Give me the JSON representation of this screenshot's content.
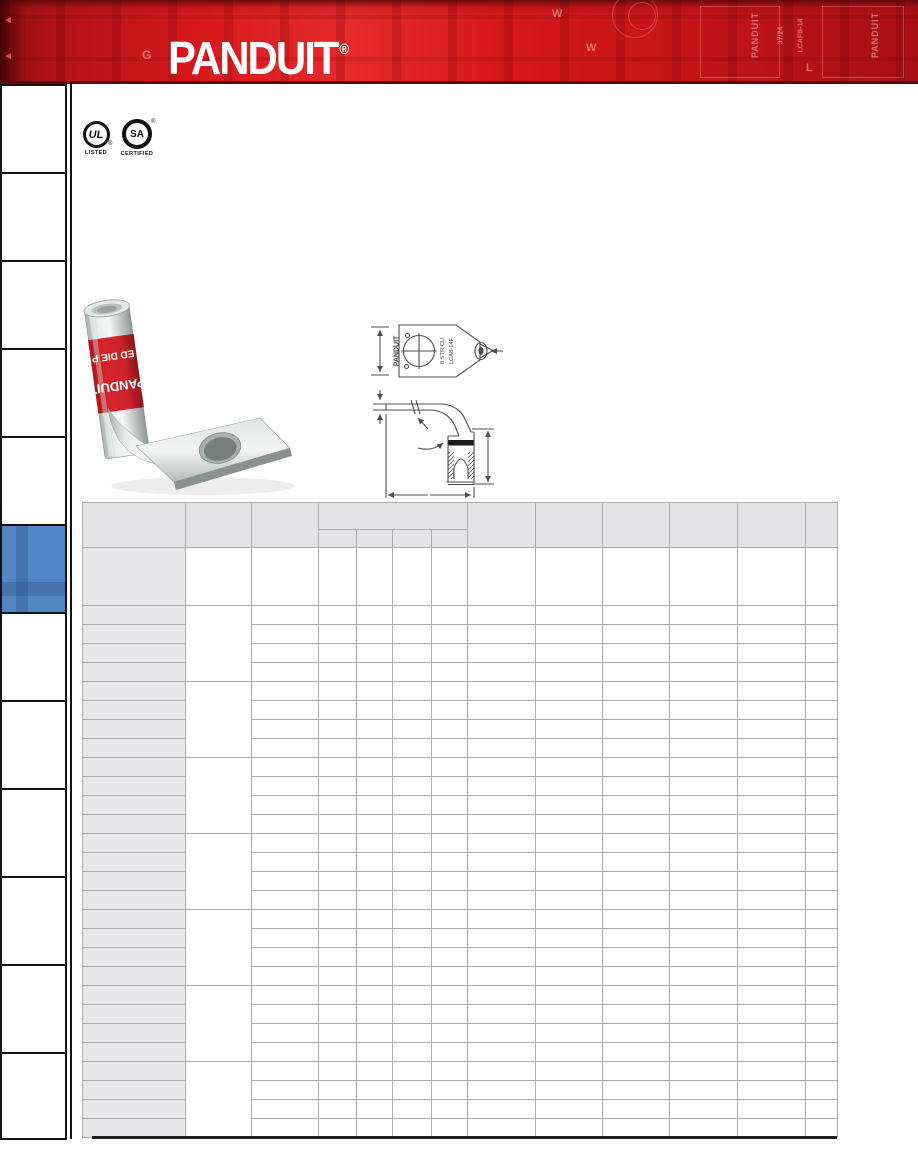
{
  "brand": {
    "logo_text": "PANDUIT",
    "registered": "®"
  },
  "header_pattern": {
    "labels": {
      "g": "G",
      "w_vert": "W",
      "w_dim": "W",
      "l": "L",
      "panduit1": "PANDUIT",
      "panduit2": "PANDUIT",
      "part1": "37/24",
      "part2": "LCAFB-14"
    }
  },
  "certifications": {
    "ul": {
      "monogram": "UL",
      "caption": "LISTED",
      "registered": "®"
    },
    "csa": {
      "monogram": "SA",
      "caption": "CERTIFIED",
      "registered": "®"
    }
  },
  "sidebar": {
    "tab_count": 12,
    "active_index": 5,
    "active_color": "#5285c6"
  },
  "product_photo": {
    "band_line1": "ED DIE P",
    "band_line2": "PANDUIT"
  },
  "diagram_top_view": {
    "brand": "PANDUIT",
    "marking_line1": "8 STR CU",
    "marking_line2": "LCA8-14F"
  },
  "table": {
    "columns": 13,
    "group_header": {
      "start": 3,
      "span": 4
    },
    "has_tall_first_row": true,
    "row_groups": 7,
    "rows_per_group": 4,
    "merged_column_index": 1,
    "all_cells_empty": true
  },
  "colors": {
    "header_red": "#d8191e",
    "active_tab_blue": "#5285c6",
    "table_grid": "#ababaf",
    "header_cell_fill": "#e4e4e6",
    "first_col_fill": "#e7e7e9",
    "rule_black": "#1f1f1f"
  }
}
